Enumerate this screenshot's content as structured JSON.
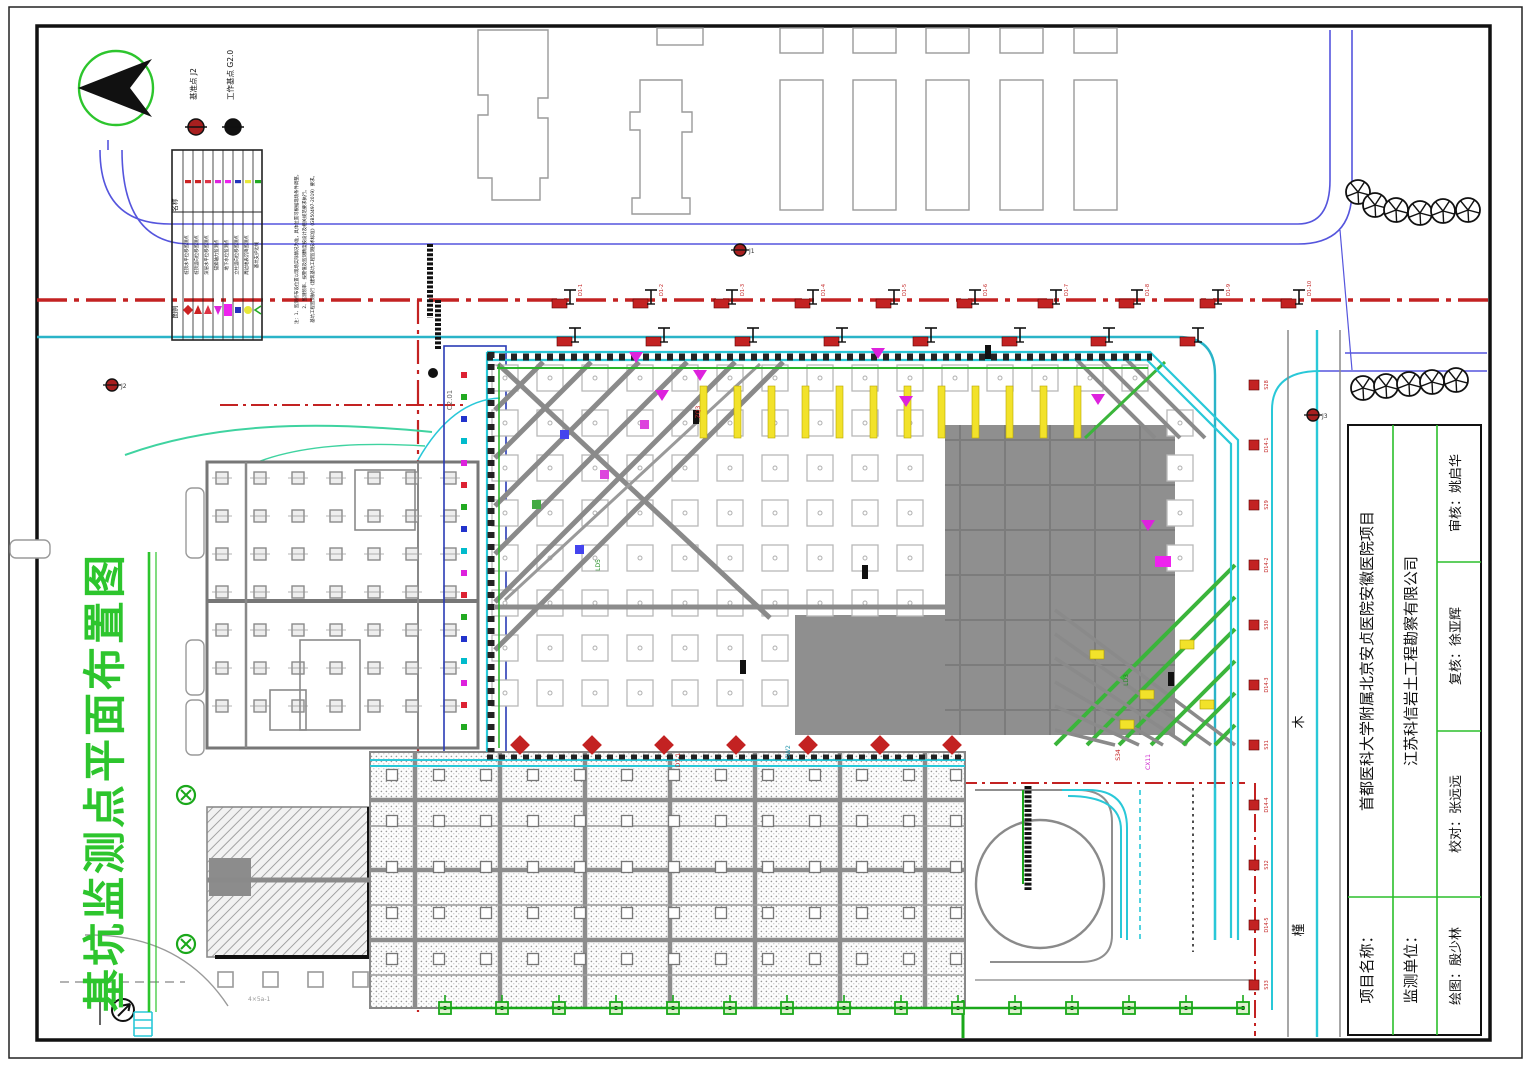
{
  "drawing": {
    "title": "基坑监测点平面布置图",
    "title_color": "#2dc52d"
  },
  "benchmark_key": {
    "datum_label": "基准点 J2",
    "working_label": "工作基点 G2.0"
  },
  "legend": {
    "header_name": "名称",
    "header_symbol": "图例",
    "items": [
      {
        "label": "桩顶水平位移监测点",
        "color": "#cc2222",
        "shape": "diamond"
      },
      {
        "label": "桩顶竖向位移监测点",
        "color": "#cc2222",
        "shape": "flag"
      },
      {
        "label": "深层水平位移监测点",
        "color": "#dd3344",
        "shape": "flag"
      },
      {
        "label": "锚索轴力监测点",
        "color": "#dd22dd",
        "shape": "arrow"
      },
      {
        "label": "地下水位监测点",
        "color": "#ee22ee",
        "shape": "rect"
      },
      {
        "label": "立柱竖向位移监测点",
        "color": "#2233bb",
        "shape": "square"
      },
      {
        "label": "周边地表沉降监测点",
        "color": "#e8e838",
        "shape": "circle"
      },
      {
        "label": "基坑支护边线",
        "color": "#22aa22",
        "shape": "angle"
      }
    ],
    "notes": [
      "注：1、监测点布设位置以现场实际情况为准，具体位置可根据现场条件调整。",
      "2、监测频率、报警值及监测精度按设计及相关规范要求执行。",
      "基坑工程监测执行《建筑基坑工程监测技术标准》（GB50497-2019）要求。"
    ]
  },
  "plan": {
    "wall_label": "C2.01",
    "road_chars": [
      "木",
      "槿"
    ],
    "benchmark_points": [
      "J1",
      "J2",
      "J3"
    ],
    "building_note": "4×5a-1",
    "micro_labels": [
      "LD5",
      "SW2",
      "S34",
      "D7-1",
      "CX11",
      "ZQ3",
      "LD3"
    ],
    "top_labels": [
      "D1-1",
      "D1-2",
      "D1-3",
      "D1-4",
      "D1-5",
      "D1-6",
      "D1-7",
      "D1-8",
      "D1-9",
      "D1-10"
    ],
    "east_labels": [
      "S28",
      "D14-1",
      "S29",
      "D14-2",
      "S30",
      "D14-3",
      "S31",
      "D14-4",
      "S32",
      "D14-5",
      "S33"
    ]
  },
  "title_block": {
    "project_label": "项目名称：",
    "project_name": "首都医科大学附属北京安贞医院安徽医院项目",
    "unit_label": "监测单位：",
    "unit_name": "江苏科信岩土工程勘察有限公司",
    "reviewer": "审核：姚启华",
    "checker": "复核：徐亚辉",
    "proofreader": "校对：张远远",
    "drafter": "绘图：殷少林"
  }
}
